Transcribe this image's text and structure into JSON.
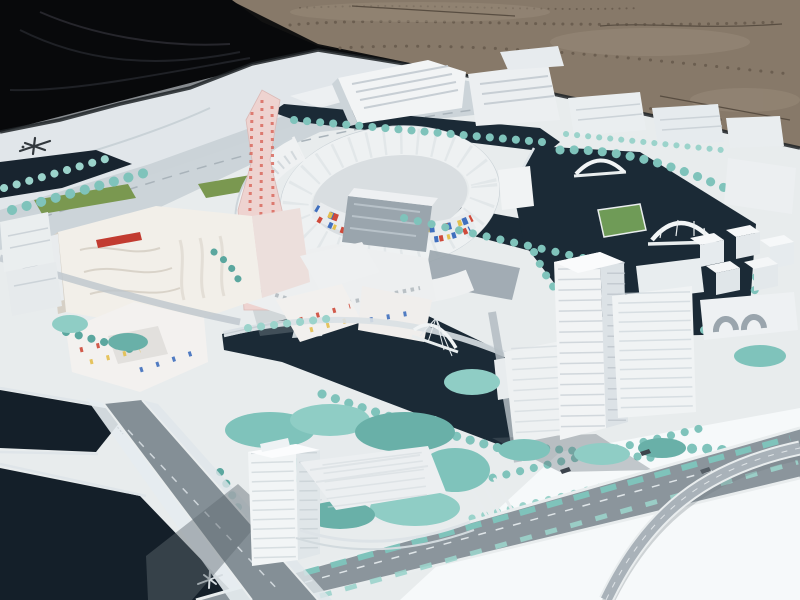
{
  "meta": {
    "title": "Outdoor photograph of a white urban master-plan architectural scale model on a gravel lot, partly covered foreground by a black tarp",
    "width": 800,
    "height": 600
  },
  "scene": {
    "background": {
      "ground": "brown gravel dirt lot",
      "cover": "black tarp (top-left)",
      "base": "large white model baseboard in oblique perspective"
    },
    "elements": {
      "board_logo_mark": "small illegible dark glyph printed on board, top-left",
      "road_glyph_mark": "small illegible light glyph printed on avenue, bottom-left",
      "landmark_tower": "tall pink speckled zig-zag tower",
      "circular_plaza": "elliptical courtyard ring building with colorful mosaic inner facade",
      "industrial_row": "sawtooth-roof factory blocks along top",
      "east_tower_cluster": "three white high-rise slabs right of the lake",
      "island_tower": "translucent white tower on landscaped island, bottom-center",
      "bridges": "two arched bridges over the lake, one cable-stay bridge over the canal",
      "water": "dark navy canals and lake weaving through the plan",
      "trees": "rows and clusters of teal foam model trees",
      "boulevard": "wide gray boulevard with teal planted medians and crosswalk",
      "flyover": "curved flyover ramp sweeping across the empty bottom-right board"
    }
  },
  "palette": {
    "tarp": "#08090b",
    "tarpFold": "#1f2126",
    "gravel": "#877969",
    "gravelDark": "#6b5e50",
    "gravelLight": "#9c8e7d",
    "gravelCrack": "#584d41",
    "board": "#e8eced",
    "boardBright": "#f6f9fa",
    "boardCool": "#dce3e7",
    "edgeShadow": "#1d2226",
    "water": "#1b2a36",
    "waterDeep": "#141f29",
    "bank": "#dfe5e9",
    "road": "#8b959c",
    "roadDark": "#848f96",
    "roadLight": "#c3ccd2",
    "curb": "#e9edee",
    "tree": "#7fc3bb",
    "treeDark": "#5ba79f",
    "treeLight": "#9bd3cb",
    "lawn": "#7a9850",
    "field": "#6f9b57",
    "bldg": "#f2f4f5",
    "bldgShade": "#d8dee2",
    "bldgSide": "#c9d1d7",
    "bldgLine": "#c8d0d6",
    "glass": "#9aa5ad",
    "glassStreak": "#b8c2c9",
    "cream": "#f2efe9",
    "creamLine": "#d9d3c9",
    "pink": "#eed3d0",
    "pinkDot": "#d96a5f",
    "mosaicRed": "#cf4a3a",
    "mosaicBlue": "#3f6fbe",
    "mosaicYellow": "#e4bf4e",
    "accentRed": "#c23b30",
    "shadow": "#5f6a72",
    "markDark": "#32383d",
    "markLight": "#d5dce0",
    "car": "#3c444c"
  }
}
